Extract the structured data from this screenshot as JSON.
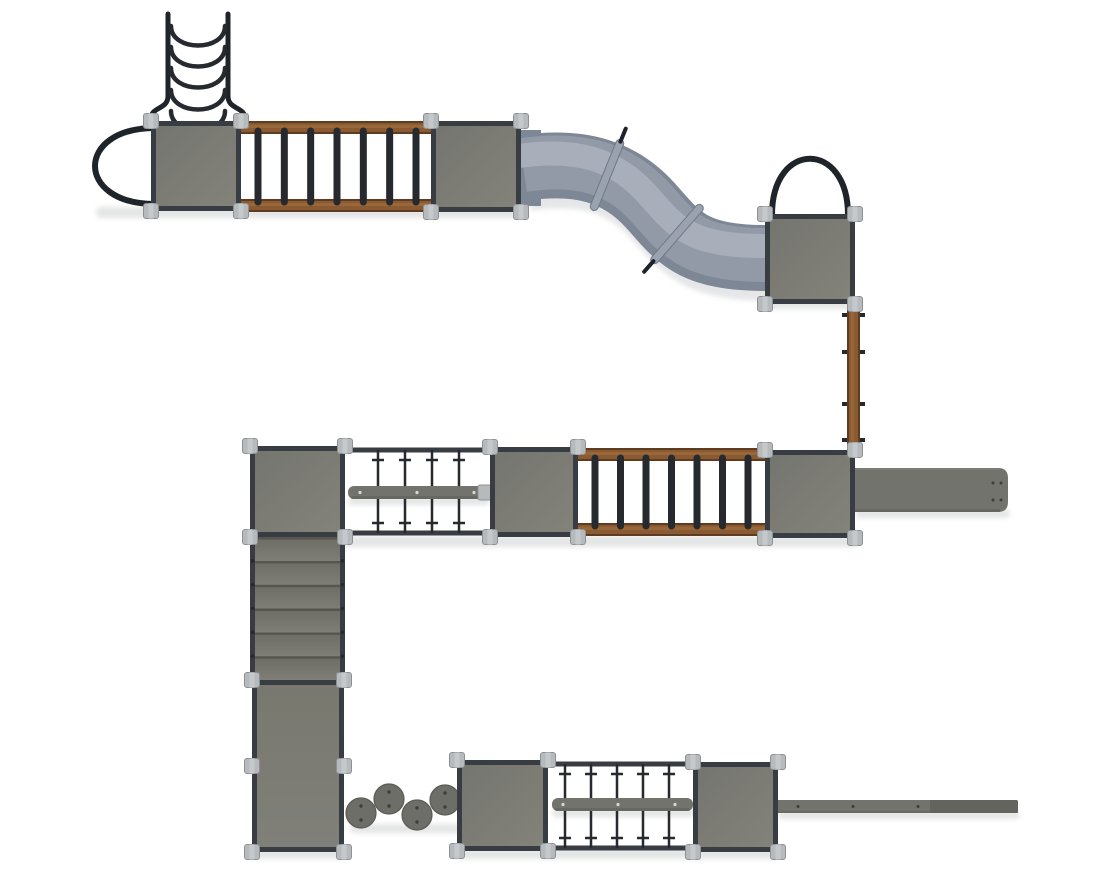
{
  "meta": {
    "description": "top-view-render-of-modular-playground-structure",
    "background": "#ffffff",
    "width": 1110,
    "height": 879
  },
  "colors": {
    "platform1": "#757570",
    "platform2": "#83837a",
    "frame": "#383d44",
    "connector": "#b7babc",
    "connectorEdge": "#8e9194",
    "connectorSeam": "#c6c9cb",
    "wood": "#8a5a33",
    "woodDark": "#5f3c20",
    "woodLight": "#9b6a3c",
    "rung": "#26292e",
    "rope": "#26292e",
    "arch": "#1f242a",
    "tubeBase": "#7e8795",
    "tubeMid": "#929aa7",
    "tubeHighlight": "#a9afba",
    "tubeShadow": "#d0d3d5",
    "collar": "#9aa2af",
    "collarEdge": "#6f7888",
    "beam": "#73736d",
    "beamDark": "#64645e",
    "beamDot": "#d9d9d3",
    "stone": "#6e6e68",
    "stoneEdge": "#5b5b55",
    "stoneDot": "#3e3e3a",
    "stepTop": "#6c6c65",
    "stepBottom": "#7e7e77",
    "stepEdge": "#53534d",
    "panelTop": "#78786f",
    "panelBottom": "#80807a",
    "shadow": "#c9cccd"
  },
  "scene": {
    "shadows": [
      {
        "x": 96,
        "y": 207,
        "w": 426,
        "h": 11
      },
      {
        "x": 760,
        "y": 299,
        "w": 100,
        "h": 10
      },
      {
        "x": 250,
        "y": 536,
        "w": 610,
        "h": 11
      },
      {
        "x": 855,
        "y": 509,
        "w": 155,
        "h": 9
      },
      {
        "x": 348,
        "y": 497,
        "w": 142,
        "h": 8
      },
      {
        "x": 248,
        "y": 849,
        "w": 100,
        "h": 10
      },
      {
        "x": 350,
        "y": 824,
        "w": 112,
        "h": 9
      },
      {
        "x": 455,
        "y": 849,
        "w": 325,
        "h": 10
      },
      {
        "x": 552,
        "y": 809,
        "w": 143,
        "h": 8
      },
      {
        "x": 778,
        "y": 811,
        "w": 242,
        "h": 8
      }
    ],
    "platforms": [
      {
        "id": "platform-top-left",
        "x": 151,
        "y": 121,
        "w": 90,
        "h": 90
      },
      {
        "id": "platform-top-mid",
        "x": 431,
        "y": 121,
        "w": 90,
        "h": 91
      },
      {
        "id": "platform-slide-top",
        "x": 765,
        "y": 214,
        "w": 90,
        "h": 90
      },
      {
        "id": "platform-mid-left",
        "x": 250,
        "y": 446,
        "w": 95,
        "h": 91
      },
      {
        "id": "platform-mid-center",
        "x": 490,
        "y": 447,
        "w": 88,
        "h": 90
      },
      {
        "id": "platform-mid-right",
        "x": 765,
        "y": 450,
        "w": 90,
        "h": 88
      },
      {
        "id": "platform-bottom-left",
        "x": 457,
        "y": 760,
        "w": 91,
        "h": 91
      },
      {
        "id": "platform-bottom-right",
        "x": 693,
        "y": 762,
        "w": 85,
        "h": 90
      }
    ],
    "arches": [
      {
        "id": "entry-arch-left",
        "type": "left",
        "x": 155,
        "y1": 128,
        "y2": 204,
        "depth": 80
      },
      {
        "id": "entry-arch-top",
        "type": "top",
        "x1": 772,
        "x2": 848,
        "y": 215,
        "depth": 75
      }
    ],
    "curved_ladder": {
      "id": "curved-rung-climber",
      "railLx": 168,
      "railRx": 228,
      "yTop": 14,
      "yBottom": 96,
      "flare": 17,
      "flareBottom": 119,
      "rungYs": [
        26,
        47,
        68,
        90,
        111
      ],
      "sag": 26
    },
    "wood_ladders": [
      {
        "id": "overhead-wood-ladder-top",
        "x": 241,
        "y": 121,
        "w": 192,
        "h": 91,
        "railH": 13,
        "rungs": 7
      },
      {
        "id": "overhead-wood-ladder-mid",
        "x": 578,
        "y": 448,
        "w": 187,
        "h": 88,
        "railH": 13,
        "rungs": 7
      }
    ],
    "tube_slide": {
      "id": "tunnel-slide",
      "path": "M 523 168 C 578 160 618 170 650 205 C 678 236 690 258 766 258",
      "width": 66,
      "mouth": {
        "x1": 520,
        "x2": 541,
        "y": 168,
        "width": 76
      },
      "collars": [
        {
          "cx": 607,
          "cy": 175,
          "angle": 22,
          "tab": "top"
        },
        {
          "cx": 677,
          "cy": 234,
          "angle": 41,
          "tab": "bottom"
        }
      ]
    },
    "vertical_ladder": {
      "id": "vertical-wood-ladder",
      "x": 847,
      "y": 303,
      "w": 13,
      "h": 149,
      "tabYs": [
        313,
        350,
        402,
        438
      ]
    },
    "net_bridges": [
      {
        "id": "rope-net-bridge-mid",
        "x1": 345,
        "x2": 490,
        "yTop": 450,
        "yBottom": 533,
        "ropeXs": [
          378,
          405,
          432,
          459
        ]
      },
      {
        "id": "rope-net-bridge-bottom",
        "x1": 548,
        "x2": 693,
        "yTop": 764,
        "yBottom": 848,
        "ropeXs": [
          565,
          591,
          617,
          643,
          669
        ]
      }
    ],
    "balance_beams": [
      {
        "id": "balance-beam-mid",
        "x": 348,
        "y": 486,
        "w": 140,
        "h": 13,
        "dotXs": [
          360,
          417,
          474
        ]
      },
      {
        "id": "balance-beam-bottom",
        "x": 552,
        "y": 798,
        "w": 141,
        "h": 13,
        "dotXs": [
          563,
          618,
          675
        ]
      }
    ],
    "beam_end_tab": {
      "id": "beam-end-bracket",
      "x": 478,
      "y": 485,
      "w": 14,
      "h": 15
    },
    "stairs": {
      "id": "stairs",
      "x": 250,
      "y": 537,
      "w": 95,
      "h": 143,
      "steps": 6
    },
    "ramp_panel": {
      "id": "ramp-panel",
      "x": 252,
      "y": 680,
      "w": 92,
      "h": 172,
      "midY": 766
    },
    "stepping_stones": {
      "id": "stepping-stones",
      "r": 15,
      "stones": [
        {
          "cx": 361,
          "cy": 813
        },
        {
          "cx": 389,
          "cy": 799
        },
        {
          "cx": 417,
          "cy": 815
        },
        {
          "cx": 445,
          "cy": 800
        }
      ]
    },
    "slide_exit": {
      "id": "straight-slide",
      "x": 855,
      "y": 468,
      "w": 153,
      "h": 44,
      "dots": [
        [
          993,
          483
        ],
        [
          1001,
          483
        ],
        [
          993,
          500
        ],
        [
          1001,
          500
        ]
      ]
    },
    "long_beam": {
      "id": "long-balance-beam",
      "x": 777,
      "y": 800,
      "w": 241,
      "h": 13,
      "darkFrom": 930,
      "dotXs": [
        798,
        853,
        918
      ]
    }
  }
}
